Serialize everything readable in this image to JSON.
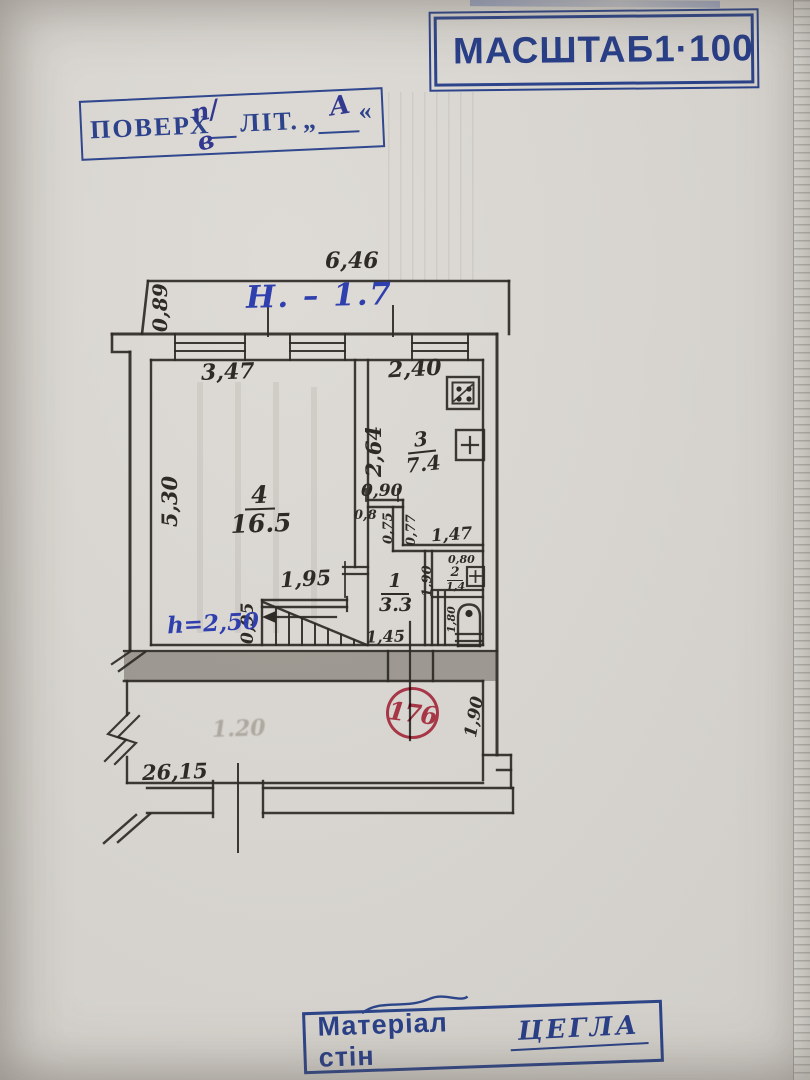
{
  "page": {
    "background": "#d8d5d0",
    "edge_strip": "#e7e5e1",
    "ink": "#2e2a26"
  },
  "stamps": {
    "scale": {
      "label": "МАСШТАБ",
      "value": "1·100",
      "color": "#2b49a6"
    },
    "floor": {
      "label": "ПОВЕРХ",
      "floor_value": "п/в",
      "lit_label": "ЛІТ.",
      "quote_open": "„",
      "letter_value": "А",
      "quote_close": "«",
      "color": "#2b49a6"
    },
    "material": {
      "label": "Матеріал стін",
      "value": "ЦЕГЛА",
      "color": "#2b49a6"
    },
    "registry": {
      "value": "176",
      "color": "#c03048"
    }
  },
  "notes": {
    "level_note": "Н. – 1.7",
    "stair_height_note": "h=2,50",
    "bleed_text": "1.20"
  },
  "plan": {
    "dims": {
      "top_width": "6,46",
      "top_offset": "0,89",
      "room4_width": "3,47",
      "room3_width": "2,40",
      "room4_height": "5,30",
      "room3_height": "2,64",
      "vest_opening": "0,90",
      "vest_left": "0,8",
      "vest_inner_left": "0,75",
      "vest_inner_right": "0,77",
      "hall_width": "1,47",
      "stair_opening": "1,95",
      "stair_width": "0,95",
      "hall_opening": "1,45",
      "wc_width": "0,80",
      "wc_height": "1,90",
      "toilet_depth": "1,80",
      "corridor_height": "1,90",
      "corridor_length": "26,15"
    },
    "rooms": {
      "r4": {
        "number": "4",
        "area": "16.5"
      },
      "r3": {
        "number": "3",
        "area": "7.4"
      },
      "r1": {
        "number": "1",
        "area": "3.3"
      },
      "r2": {
        "number": "2",
        "area": "1,4"
      }
    },
    "icons": {
      "stove": "gas-stove-icon",
      "kitchen_sink": "sink-plus-icon",
      "wc_sink": "sink-plus-icon",
      "toilet": "toilet-icon",
      "stairs": "stairs-icon",
      "wall_break": "wall-break-icon"
    }
  }
}
